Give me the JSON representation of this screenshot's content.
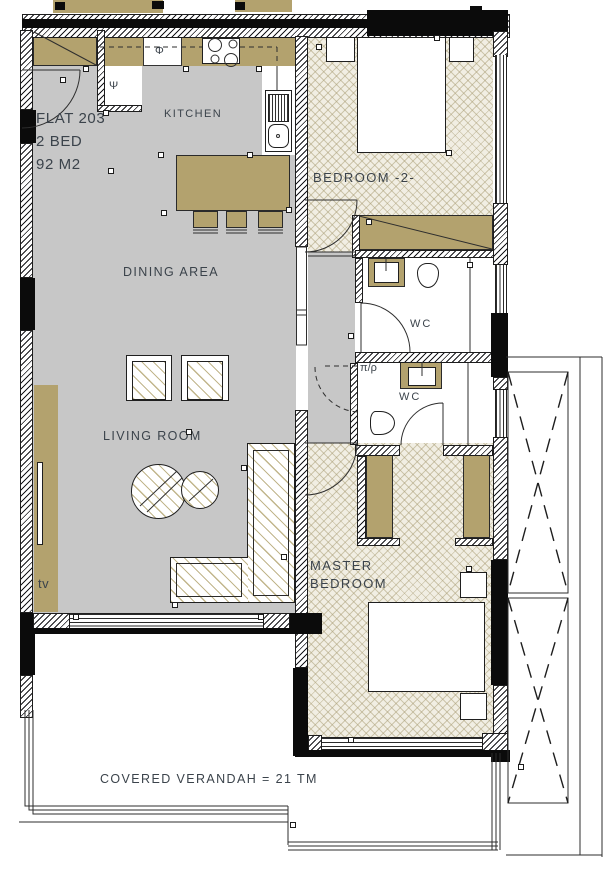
{
  "plan": {
    "flat": {
      "name": "FLAT 203",
      "beds": "2 BED",
      "area": "92 M2"
    },
    "rooms": {
      "kitchen": "KITCHEN",
      "bedroom2": "BEDROOM -2-",
      "dining": "DINING AREA",
      "living": "LIVING ROOM",
      "wc_top": "WC",
      "wc_bottom": "WC",
      "master_line1": "MASTER",
      "master_line2": "BEDROOM"
    },
    "verandah": {
      "label": "COVERED VERANDAH = 21 TM"
    },
    "fixtures": {
      "tv": "tv",
      "oven_phi": "Φ",
      "fridge_psi": "Ψ",
      "laundry_pr": "π/ρ"
    },
    "colors": {
      "wood": "#b3a26e",
      "floor_gray": "#c7c7c7",
      "parquet_base": "#f1eee3",
      "ink": "#3b434b"
    }
  }
}
